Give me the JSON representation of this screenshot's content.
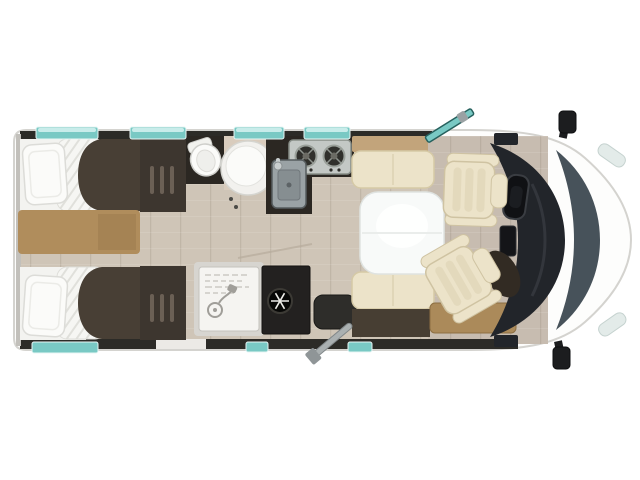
{
  "diagram": {
    "type": "motorhome-floorplan-top-view",
    "orientation": "front-of-vehicle-right",
    "areas": [
      "twin-single-beds",
      "foot-of-bed-wardrobes",
      "washroom",
      "shower-cubicle",
      "kitchen",
      "fridge",
      "dinette-with-table",
      "swivel-cab-seats",
      "driver-cab"
    ]
  },
  "icons": {
    "fridge": "snowflake-icon",
    "shower": "shower-head-icon",
    "stove": "two-burner-hob-icon",
    "toilet": "toilet-top-view-icon",
    "basin": "round-washbasin-icon",
    "steering": "steering-wheel-icon",
    "door": "open-entry-door",
    "crank": "awning-crank-handle"
  },
  "colors": {
    "body": "#fdfdfc",
    "outline": "#d4d3cf",
    "wall": "#2c2b27",
    "window": "#79c9c4",
    "windowLight": "#c8ecea",
    "floor": "#cfc5b7",
    "floorCab": "#c7bcb0",
    "counter": "#2b2722",
    "bedDark": "#483f35",
    "wardrobe": "#3d362f",
    "tan": "#b08d5c",
    "sideboard": "#c2a47b",
    "benchDark": "#473e33",
    "stepTan": "#ab8a5a",
    "cream": "#ece3c9",
    "table": "#f8faf9",
    "white": "#fbfbf9",
    "showerTray": "#f5f4f1",
    "fridge": "#232120",
    "stepDark": "#2e2d2a",
    "steel": "#c3c8c5",
    "sinkSteel": "#9aa2a5",
    "dash": "#22252a",
    "windshield": "#47525a",
    "mirror": "#1c1d1f",
    "headlight": "#e3ebe9",
    "crankGray": "#aab0b1"
  }
}
